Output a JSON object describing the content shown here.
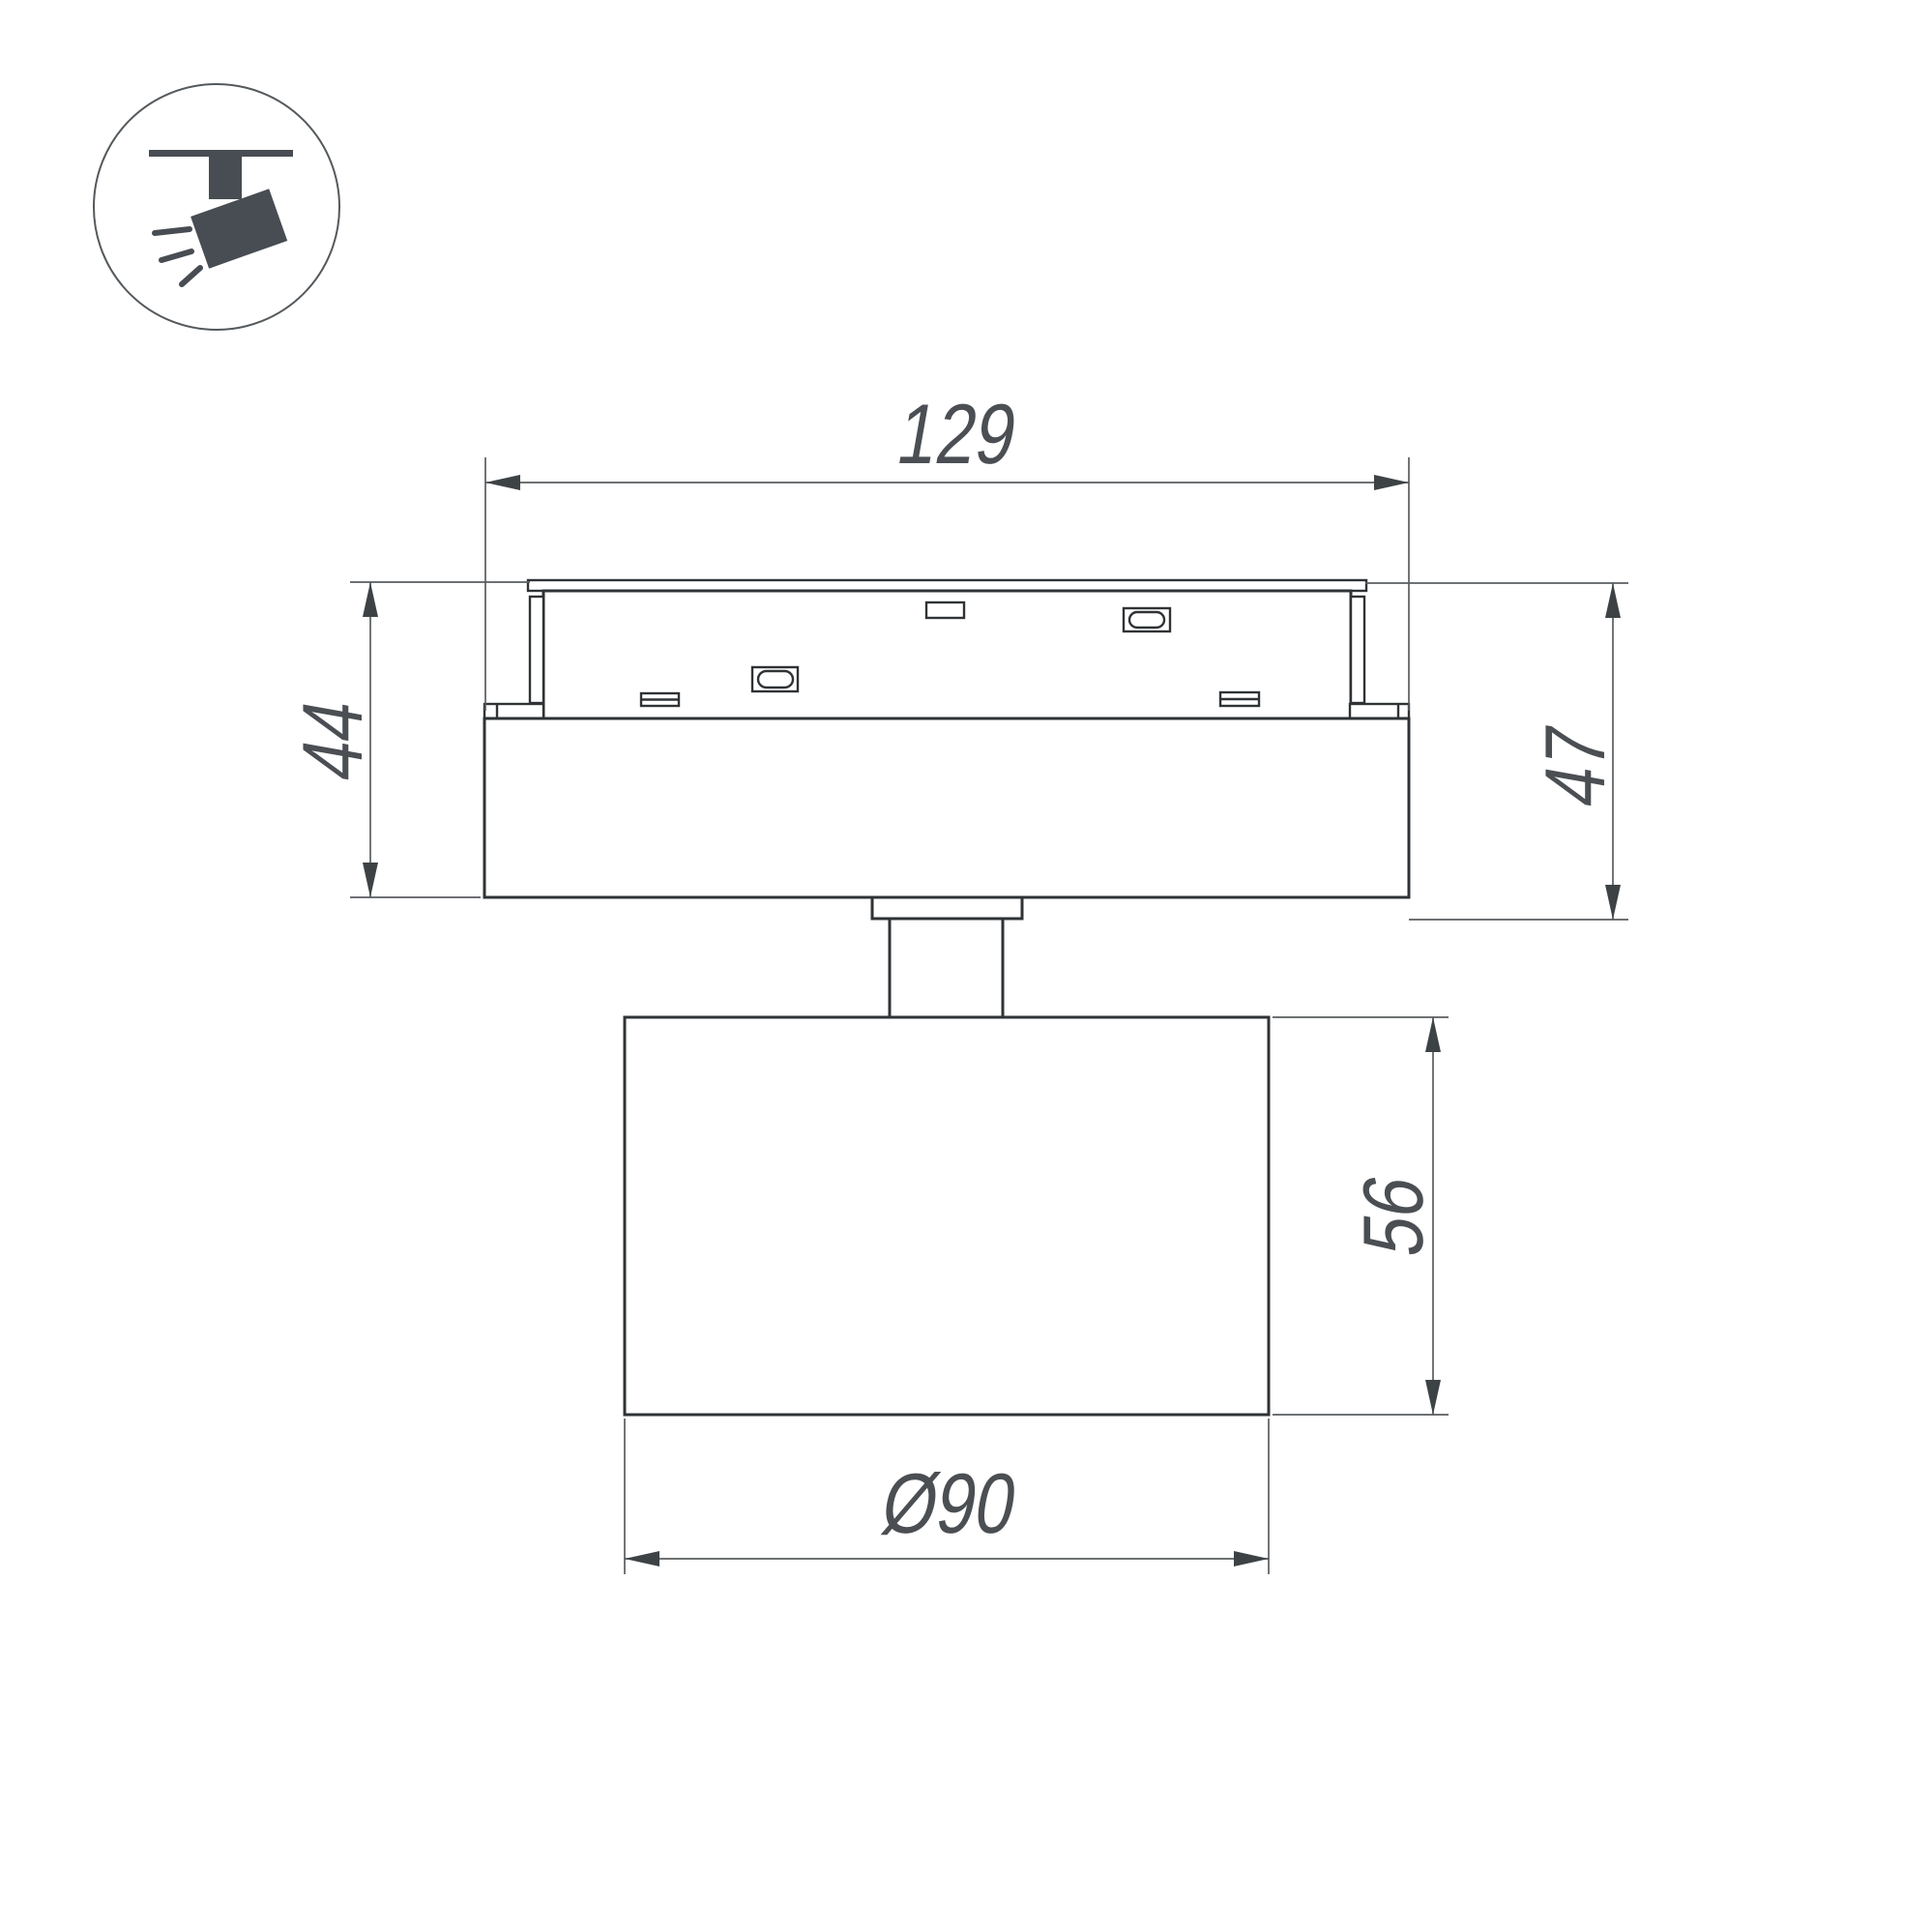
{
  "background": "#ffffff",
  "colors": {
    "outline": "#2f3336",
    "dimension_line": "#595d60",
    "arrow": "#3d4245",
    "text": "#4b4f53",
    "icon": "#474d52",
    "icon_circle_border": "#54595d"
  },
  "icon": {
    "name": "track-spotlight-icon"
  },
  "dimensions": {
    "track_width": {
      "value": "129",
      "orientation": "horizontal"
    },
    "left_height": {
      "value": "44",
      "orientation": "vertical"
    },
    "right_height": {
      "value": "47",
      "orientation": "vertical"
    },
    "body_height": {
      "value": "56",
      "orientation": "vertical"
    },
    "body_diameter": {
      "value": "Ø90",
      "orientation": "horizontal"
    }
  }
}
